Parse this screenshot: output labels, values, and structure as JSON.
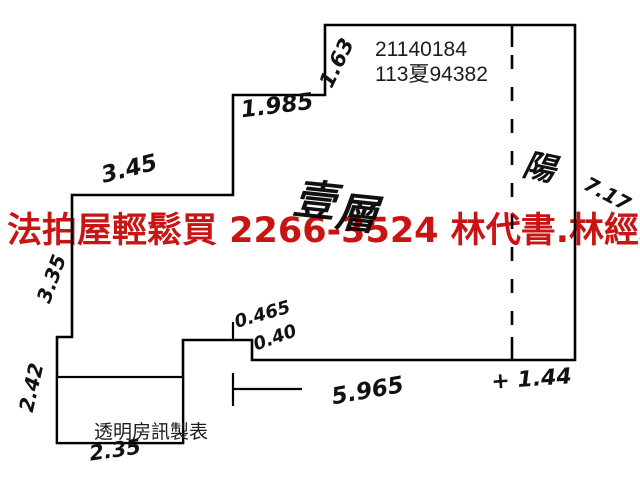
{
  "canvas": {
    "background": "#ffffff",
    "line_color": "#000000"
  },
  "overlay_banner": {
    "text": "法拍屋輕鬆買  2266-3524  林代書.林經理",
    "color": "#c91414"
  },
  "plan": {
    "stroke_color": "#000000",
    "stroke_width": 2.6,
    "outline_points": [
      [
        325,
        25
      ],
      [
        575,
        25
      ],
      [
        575,
        360
      ],
      [
        252,
        360
      ],
      [
        252,
        340
      ],
      [
        183,
        340
      ],
      [
        183,
        443
      ],
      [
        57,
        443
      ],
      [
        57,
        337
      ],
      [
        72,
        337
      ],
      [
        72,
        195
      ],
      [
        233,
        195
      ],
      [
        233,
        95
      ],
      [
        325,
        95
      ]
    ],
    "dashed_partition": {
      "x": 512,
      "y_top": 25,
      "y_bottom": 360,
      "solid_top_end": 47,
      "solid_bottom_start": 337,
      "dash_pattern": "14 18"
    },
    "tick_segments": [
      [
        233,
        322,
        233,
        340
      ],
      [
        233,
        373,
        233,
        406
      ],
      [
        233,
        389,
        302,
        389
      ]
    ],
    "watermark_box": {
      "x": 57,
      "y": 377,
      "w": 126,
      "h": 66
    },
    "handwritten_labels": [
      {
        "name": "dim-1-63",
        "text": "1.63",
        "x": 343,
        "y": 66,
        "rotate": -64,
        "size": 21
      },
      {
        "name": "dim-1-985",
        "text": "1.985",
        "x": 278,
        "y": 113,
        "rotate": -7,
        "size": 23
      },
      {
        "name": "dim-3-45",
        "text": "3.45",
        "x": 131,
        "y": 176,
        "rotate": -14,
        "size": 23
      },
      {
        "name": "dim-3-35",
        "text": "3.35",
        "x": 58,
        "y": 281,
        "rotate": -70,
        "size": 20
      },
      {
        "name": "dim-2-42",
        "text": "2.42",
        "x": 38,
        "y": 389,
        "rotate": -77,
        "size": 20
      },
      {
        "name": "dim-2-35",
        "text": "2.35",
        "x": 116,
        "y": 457,
        "rotate": -8,
        "size": 21
      },
      {
        "name": "dim-0-465",
        "text": "0.465",
        "x": 264,
        "y": 320,
        "rotate": -16,
        "size": 18
      },
      {
        "name": "dim-0-40",
        "text": "0.40",
        "x": 277,
        "y": 343,
        "rotate": -20,
        "size": 18
      },
      {
        "name": "dim-5-965",
        "text": "5.965",
        "x": 369,
        "y": 398,
        "rotate": -10,
        "size": 23
      },
      {
        "name": "dim-1-44",
        "text": "+ 1.44",
        "x": 532,
        "y": 386,
        "rotate": -4,
        "size": 22
      },
      {
        "name": "dim-7-17",
        "text": "7.17",
        "x": 604,
        "y": 200,
        "rotate": 28,
        "size": 20
      },
      {
        "name": "room-balcony",
        "text": "陽",
        "x": 537,
        "y": 178,
        "rotate": 12,
        "size": 32
      },
      {
        "name": "floor-char-1",
        "text": "壹",
        "x": 313,
        "y": 215,
        "rotate": 6,
        "size": 42
      },
      {
        "name": "floor-char-2",
        "text": "層",
        "x": 355,
        "y": 228,
        "rotate": 6,
        "size": 42
      }
    ],
    "printed_labels": [
      {
        "name": "case-number-line1",
        "text": "21140184",
        "x": 375,
        "y": 56,
        "size": 21
      },
      {
        "name": "case-number-line2",
        "text": "113夏94382",
        "x": 375,
        "y": 81,
        "size": 21
      },
      {
        "name": "watermark-text",
        "text": "透明房訊製表",
        "x": 94,
        "y": 438,
        "size": 19
      }
    ]
  }
}
